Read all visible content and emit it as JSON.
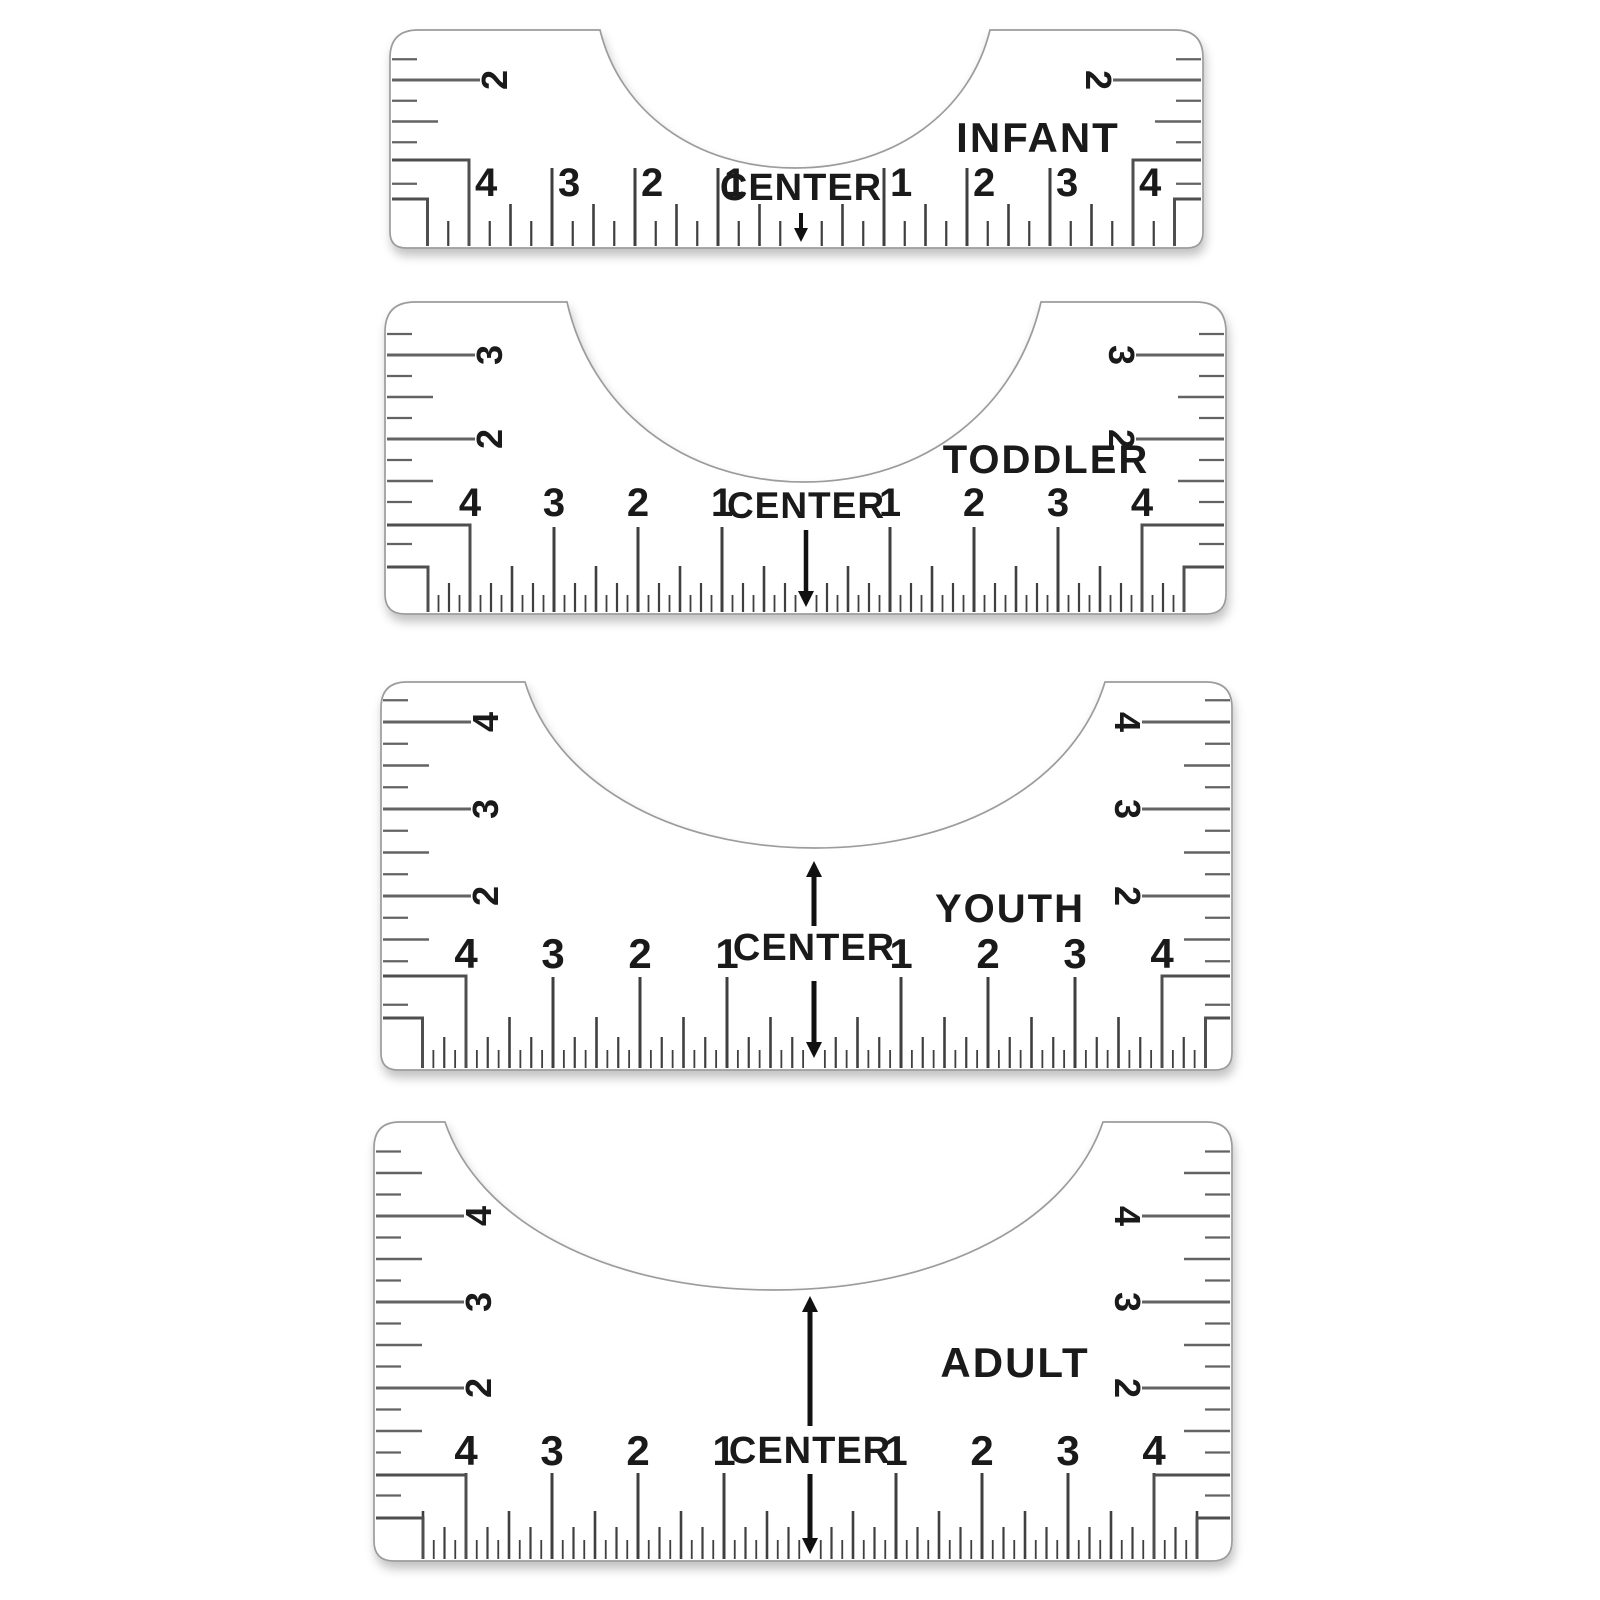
{
  "center_label": "CENTER",
  "rulers": [
    {
      "label": "INFANT",
      "side_labels": [
        "2"
      ],
      "bottom_scale": {
        "left": [
          "4",
          "3",
          "2",
          "1"
        ],
        "right": [
          "1",
          "2",
          "3",
          "4"
        ]
      },
      "arrows": {
        "up": false,
        "down": true
      }
    },
    {
      "label": "TODDLER",
      "side_labels": [
        "3",
        "2"
      ],
      "bottom_scale": {
        "left": [
          "4",
          "3",
          "2",
          "1"
        ],
        "right": [
          "1",
          "2",
          "3",
          "4"
        ]
      },
      "arrows": {
        "up": false,
        "down": true
      }
    },
    {
      "label": "YOUTH",
      "side_labels": [
        "4",
        "3",
        "2"
      ],
      "bottom_scale": {
        "left": [
          "4",
          "3",
          "2",
          "1"
        ],
        "right": [
          "1",
          "2",
          "3",
          "4"
        ]
      },
      "arrows": {
        "up": true,
        "down": true
      }
    },
    {
      "label": "ADULT",
      "side_labels": [
        "4",
        "3",
        "2"
      ],
      "bottom_scale": {
        "left": [
          "4",
          "3",
          "2",
          "1"
        ],
        "right": [
          "1",
          "2",
          "3",
          "4"
        ]
      },
      "arrows": {
        "up": true,
        "down": true
      }
    }
  ],
  "colors": {
    "ink": "#1a1a1a",
    "bottom_tick": "#3f3f3f",
    "side_tick": "#636363",
    "outline": "#9c9c9c",
    "bracket": "#4f4f4f",
    "arrow": "#111111",
    "background": "#ffffff"
  }
}
